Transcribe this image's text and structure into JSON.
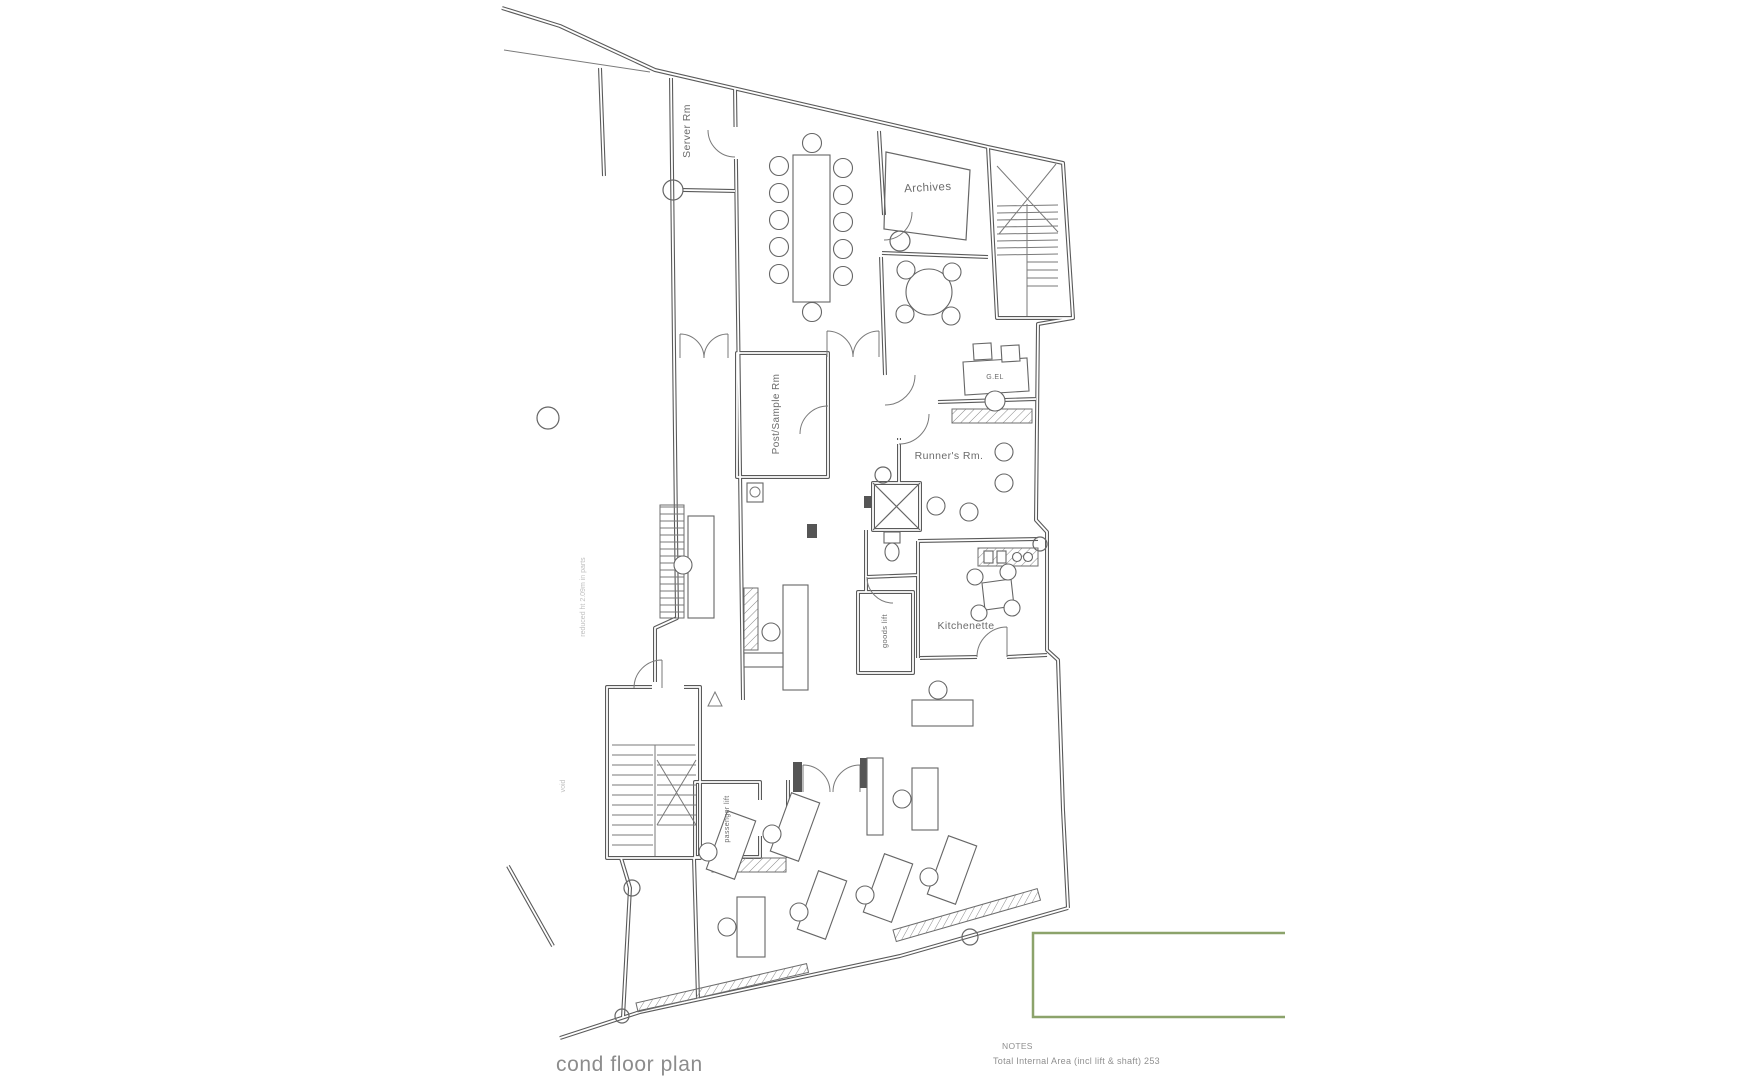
{
  "page": {
    "background": "#ffffff"
  },
  "drawing": {
    "title": "cond floor plan",
    "labels": {
      "server_room": "Server Rm",
      "archives": "Archives",
      "desk_tag": "G.EL",
      "runners_room": "Runner's Rm.",
      "post_sample_room": "Post/Sample Rm",
      "kitchenette": "Kitchenette",
      "goods_lift": "goods lift",
      "passenger_lift": "passenger lift"
    },
    "annotations": {
      "reduced_height": "reduced ht 2.09m in parts",
      "side_note": "void"
    },
    "notes": {
      "heading": "NOTES",
      "total_area": "Total Internal Area (incl lift & shaft) 253"
    },
    "colors": {
      "wall_line": "#5a5a5a",
      "label_text": "#6b6b6b",
      "highlight_box": "#8ca36b"
    }
  }
}
